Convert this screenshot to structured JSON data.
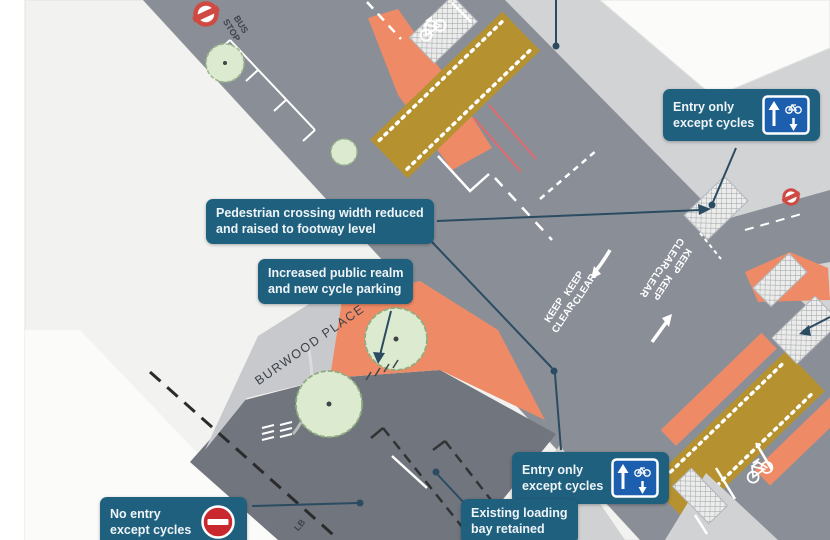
{
  "callouts": {
    "pedestrian_crossing": {
      "line1": "Pedestrian crossing width reduced",
      "line2": "and raised to footway level"
    },
    "public_realm": {
      "line1": "Increased public realm",
      "line2": "and new cycle parking"
    },
    "entry_only_top": {
      "line1": "Entry only",
      "line2": "except cycles"
    },
    "entry_only_bottom": {
      "line1": "Entry only",
      "line2": "except cycles"
    },
    "no_entry": {
      "line1": "No entry",
      "line2": "except cycles"
    },
    "loading_bay": {
      "line1": "Existing loading",
      "line2": "bay retained"
    }
  },
  "street_labels": {
    "burwood_place": "BURWOOD PLACE"
  },
  "road_markings": {
    "keep": "KEEP",
    "clear": "CLEAR",
    "bus_stop_line1": "BUS",
    "bus_stop_line2": "STOP",
    "loading_bay_abbr": "LB"
  },
  "colors": {
    "callout_teal": "#20607f",
    "sign_blue": "#1c5fae",
    "no_entry_red": "#c9282e",
    "roundel_red": "#cf4a42",
    "main_road_gray": "#8a8f97",
    "side_road_gray": "#70757e",
    "footway_gray": "#d2d3d5",
    "new_footway_orange": "#ee8a66",
    "raised_crossing_tan": "#b5922f",
    "tree_green": "#dcead0",
    "paper_background": "#eff0ed"
  }
}
